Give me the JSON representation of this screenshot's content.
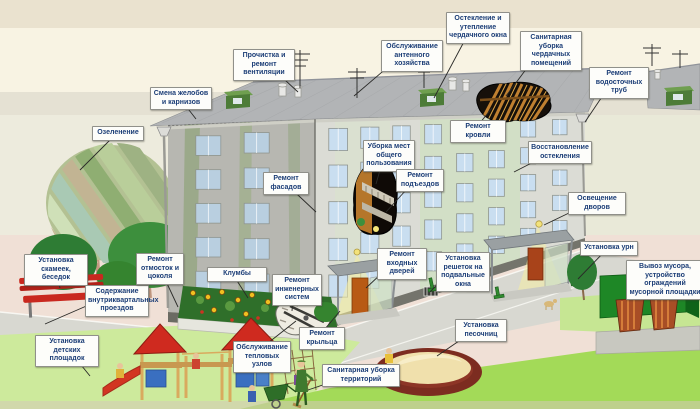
{
  "diagram": {
    "language": "ru",
    "subject": "housing-maintenance-services-scheme"
  },
  "labels": [
    {
      "id": "vent-cleaning",
      "text": "Прочистка и ремонт вентиляции",
      "x": 233,
      "y": 49,
      "w": 56,
      "tx": 298,
      "ty": 92
    },
    {
      "id": "gutters-cornices",
      "text": "Смена желобов и карнизов",
      "x": 150,
      "y": 87,
      "w": 56,
      "tx": 196,
      "ty": 119
    },
    {
      "id": "antenna-service",
      "text": "Обслуживание антенного хозяйства",
      "x": 381,
      "y": 40,
      "w": 56,
      "tx": 354,
      "ty": 96
    },
    {
      "id": "attic-window-glazing",
      "text": "Остекление и утепление чердачного окна",
      "x": 446,
      "y": 12,
      "w": 58,
      "tx": 434,
      "ty": 98
    },
    {
      "id": "attic-cleaning",
      "text": "Санитарная уборка чердачных помещений",
      "x": 520,
      "y": 31,
      "w": 56,
      "tx": 506,
      "ty": 96
    },
    {
      "id": "downpipe-repair",
      "text": "Ремонт водосточных труб",
      "x": 589,
      "y": 67,
      "w": 54,
      "tx": 585,
      "ty": 122
    },
    {
      "id": "greening",
      "text": "Озеленение",
      "x": 92,
      "y": 126,
      "w": 46,
      "tx": 80,
      "ty": 170
    },
    {
      "id": "facade-repair",
      "text": "Ремонт фасадов",
      "x": 263,
      "y": 172,
      "w": 40,
      "tx": 316,
      "ty": 212
    },
    {
      "id": "roof-repair",
      "text": "Ремонт кровли",
      "x": 450,
      "y": 120,
      "w": 50,
      "tx": 492,
      "ty": 108
    },
    {
      "id": "common-areas-cleaning",
      "text": "Уборка мест общего пользования",
      "x": 363,
      "y": 140,
      "w": 46,
      "tx": 376,
      "ty": 184
    },
    {
      "id": "entrance-halls-repair",
      "text": "Ремонт подъездов",
      "x": 396,
      "y": 169,
      "w": 42,
      "tx": 386,
      "ty": 212
    },
    {
      "id": "glazing-restoration",
      "text": "Восстановление остекления",
      "x": 528,
      "y": 141,
      "w": 58,
      "tx": 514,
      "ty": 172
    },
    {
      "id": "yard-lighting",
      "text": "Освещение дворов",
      "x": 568,
      "y": 192,
      "w": 52,
      "tx": 544,
      "ty": 225
    },
    {
      "id": "urns-install",
      "text": "Установка урн",
      "x": 580,
      "y": 241,
      "w": 52,
      "tx": 578,
      "ty": 279
    },
    {
      "id": "garbage-removal",
      "text": "Вывоз мусора, устройство ограждений мусорной площадки",
      "x": 626,
      "y": 260,
      "w": 72,
      "tx": 652,
      "ty": 298
    },
    {
      "id": "benches-install",
      "text": "Установка скамеек, беседок",
      "x": 24,
      "y": 254,
      "w": 58,
      "tx": 60,
      "ty": 288
    },
    {
      "id": "driveways-maintenance",
      "text": "Содержание внутриквартальных проездов",
      "x": 85,
      "y": 285,
      "w": 58,
      "tx": 45,
      "ty": 324
    },
    {
      "id": "playgrounds-install",
      "text": "Установка детских площадок",
      "x": 35,
      "y": 335,
      "w": 58,
      "tx": 90,
      "ty": 376
    },
    {
      "id": "blind-area-repair",
      "text": "Ремонт отмосток и цоколя",
      "x": 136,
      "y": 253,
      "w": 42,
      "tx": 178,
      "ty": 307
    },
    {
      "id": "flowerbeds",
      "text": "Клумбы",
      "x": 207,
      "y": 267,
      "w": 54,
      "tx": 248,
      "ty": 298
    },
    {
      "id": "engineering-systems",
      "text": "Ремонт инженерных систем",
      "x": 272,
      "y": 274,
      "w": 44,
      "tx": 292,
      "ty": 311
    },
    {
      "id": "entrance-doors-repair",
      "text": "Ремонт входных дверей",
      "x": 377,
      "y": 248,
      "w": 44,
      "tx": 366,
      "ty": 288
    },
    {
      "id": "basement-grilles",
      "text": "Установка решеток на подвальные окна",
      "x": 436,
      "y": 252,
      "w": 48,
      "tx": 430,
      "ty": 292
    },
    {
      "id": "heat-units-service",
      "text": "Обслуживание тепловых узлов",
      "x": 233,
      "y": 341,
      "w": 52,
      "tx": 296,
      "ty": 321
    },
    {
      "id": "porch-repair",
      "text": "Ремонт крыльца",
      "x": 299,
      "y": 327,
      "w": 40,
      "tx": 340,
      "ty": 311
    },
    {
      "id": "territory-cleaning",
      "text": "Санитарная уборка территорий",
      "x": 322,
      "y": 364,
      "w": 72,
      "tx": 308,
      "ty": 390
    },
    {
      "id": "sandboxes-install",
      "text": "Установка песочниц",
      "x": 455,
      "y": 319,
      "w": 46,
      "tx": 437,
      "ty": 356
    }
  ],
  "colors": {
    "label_text": "#1c3e77",
    "label_bg": "#fdfdfa",
    "label_border": "#90908a",
    "leader_line": "#2a2a28",
    "sky_top": "#eae2cf",
    "sky": "#f8f3e3",
    "band": "#e5e1d3",
    "backdrop": "#edebdd",
    "pavement": "#f0e0d6",
    "road": "#d8d8d1",
    "grass_light": "#cdea9c",
    "grass_bright": "#a3da58",
    "grass_right": "#c6e693",
    "wall_front": "#dbdcd5",
    "wall_side": "#b7b7b1",
    "wall_tint": "#cfe0c0",
    "roof": "#b2b4b6",
    "rafters": "#c08030",
    "window": "#c9def0",
    "basement": "#74746c",
    "door": "#b85a14",
    "bench": "#c9281f",
    "playground_roof": "#cf2a1f",
    "playground_wood": "#d9aa5e",
    "playground_panel": "#3a6fc0",
    "sandbox_rim": "#7c2c20",
    "sand": "#f0e0ac",
    "bin_fence": "#1e8726",
    "bin": "#a84e26",
    "light_cone": "#f7ef9e"
  }
}
